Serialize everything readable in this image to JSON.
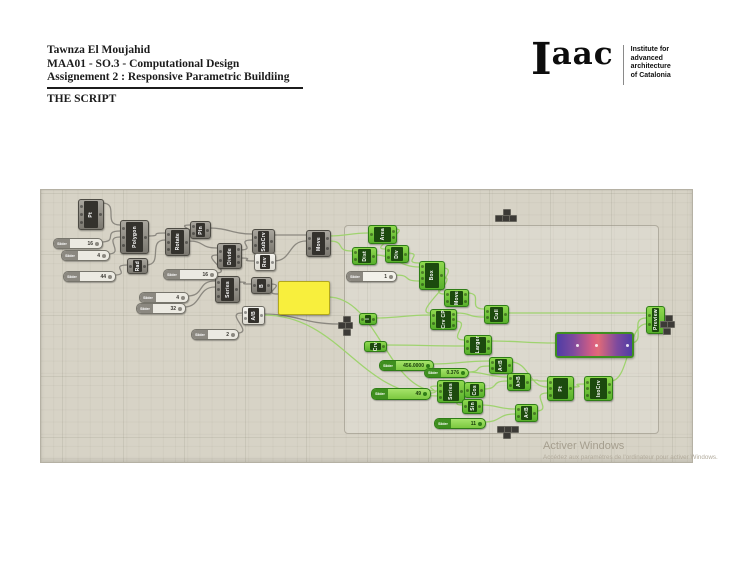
{
  "header": {
    "author": "Tawnza El Moujahid",
    "course": "MAA01 - SO.3 - Computational Design",
    "assignment": "Assignement 2 : Responsive Parametric Buildiing",
    "section_title": "THE SCRIPT"
  },
  "logo": {
    "wordmark_i": "I",
    "wordmark_rest": "aac",
    "tagline_lines": [
      "Institute for",
      "advanced",
      "architecture",
      "of Catalonia"
    ]
  },
  "watermark": {
    "line1": "Activer Windows",
    "line2": "Accédez aux paramètres de l'ordinateur pour activer Windows."
  },
  "colors": {
    "canvas_bg": "#d7d3c6",
    "node_dark": "#7b7870",
    "node_green": "#58b02b",
    "wire_gray": "#8b8880",
    "wire_green": "#9fd36f",
    "panel_yellow": "#f8ef3d",
    "gradient_purple": "#4f3da5",
    "gradient_red": "#e06a78"
  },
  "canvas": {
    "group": {
      "x": 344,
      "y": 225,
      "w": 313,
      "h": 207
    },
    "slider_label": "Slider",
    "nodes": [
      {
        "label": "Pt",
        "v": "dark",
        "x": 78,
        "y": 199,
        "w": 24,
        "h": 29,
        "ins": 3,
        "outs": 1
      },
      {
        "label": "Polygon",
        "v": "dark",
        "x": 120,
        "y": 220,
        "w": 27,
        "h": 32,
        "ins": 3,
        "outs": 1
      },
      {
        "label": "Rad",
        "v": "dark",
        "x": 127,
        "y": 258,
        "w": 19,
        "h": 14,
        "ins": 1,
        "outs": 1
      },
      {
        "label": "Rotate",
        "v": "dark",
        "x": 165,
        "y": 228,
        "w": 23,
        "h": 26,
        "ins": 3,
        "outs": 1
      },
      {
        "label": "Pln",
        "v": "dark",
        "x": 190,
        "y": 221,
        "w": 19,
        "h": 16,
        "ins": 2,
        "outs": 1
      },
      {
        "label": "Divide",
        "v": "dark",
        "x": 217,
        "y": 243,
        "w": 23,
        "h": 24,
        "ins": 2,
        "outs": 3
      },
      {
        "label": "SubCrv",
        "v": "dark",
        "x": 252,
        "y": 229,
        "w": 21,
        "h": 23,
        "ins": 2,
        "outs": 1
      },
      {
        "label": "Rev",
        "v": "white",
        "x": 254,
        "y": 253,
        "w": 20,
        "h": 16,
        "ins": 1,
        "outs": 1
      },
      {
        "label": "Move",
        "v": "dark",
        "x": 306,
        "y": 230,
        "w": 23,
        "h": 25,
        "ins": 2,
        "outs": 2
      },
      {
        "label": "Series",
        "v": "dark",
        "x": 215,
        "y": 276,
        "w": 23,
        "h": 25,
        "ins": 3,
        "outs": 1
      },
      {
        "label": "B",
        "v": "dark",
        "x": 251,
        "y": 277,
        "w": 19,
        "h": 15,
        "ins": 1,
        "outs": 1
      },
      {
        "label": "A/B",
        "v": "white",
        "x": 242,
        "y": 306,
        "w": 21,
        "h": 17,
        "ins": 2,
        "outs": 1
      },
      {
        "label": "Area",
        "v": "green",
        "x": 368,
        "y": 225,
        "w": 27,
        "h": 17,
        "ins": 1,
        "outs": 2
      },
      {
        "label": "Dist",
        "v": "green",
        "x": 352,
        "y": 247,
        "w": 23,
        "h": 16,
        "ins": 2,
        "outs": 1
      },
      {
        "label": "Div",
        "v": "green",
        "x": 385,
        "y": 245,
        "w": 22,
        "h": 16,
        "ins": 2,
        "outs": 1
      },
      {
        "label": "Box",
        "v": "green",
        "x": 419,
        "y": 261,
        "w": 24,
        "h": 27,
        "ins": 4,
        "outs": 1
      },
      {
        "label": "Move",
        "v": "green",
        "x": 444,
        "y": 289,
        "w": 23,
        "h": 16,
        "ins": 2,
        "outs": 2
      },
      {
        "label": "Crv CP",
        "v": "green",
        "x": 430,
        "y": 309,
        "w": 25,
        "h": 19,
        "ins": 2,
        "outs": 3
      },
      {
        "label": "Cull",
        "v": "green",
        "x": 484,
        "y": 305,
        "w": 23,
        "h": 17,
        "ins": 2,
        "outs": 1
      },
      {
        "label": "Larger",
        "v": "green",
        "x": 464,
        "y": 335,
        "w": 26,
        "h": 18,
        "ins": 2,
        "outs": 2
      },
      {
        "label": "Preview",
        "v": "green",
        "x": 646,
        "y": 306,
        "w": 17,
        "h": 26,
        "ins": 2,
        "outs": 0
      },
      {
        "label": "I",
        "v": "green",
        "x": 359,
        "y": 313,
        "w": 16,
        "h": 10,
        "ins": 1,
        "outs": 1
      },
      {
        "label": "Crv",
        "v": "green",
        "x": 364,
        "y": 341,
        "w": 21,
        "h": 9,
        "ins": 0,
        "outs": 1
      },
      {
        "label": "Series",
        "v": "green",
        "x": 437,
        "y": 380,
        "w": 26,
        "h": 21,
        "ins": 3,
        "outs": 1
      },
      {
        "label": "Cos",
        "v": "green",
        "x": 464,
        "y": 382,
        "w": 19,
        "h": 14,
        "ins": 1,
        "outs": 1
      },
      {
        "label": "Sin",
        "v": "green",
        "x": 462,
        "y": 399,
        "w": 19,
        "h": 13,
        "ins": 1,
        "outs": 1
      },
      {
        "label": "A<B",
        "v": "green",
        "x": 489,
        "y": 357,
        "w": 22,
        "h": 15,
        "ins": 2,
        "outs": 1
      },
      {
        "label": "A>B",
        "v": "green",
        "x": 507,
        "y": 373,
        "w": 22,
        "h": 16,
        "ins": 2,
        "outs": 1
      },
      {
        "label": "A<B",
        "v": "green",
        "x": 515,
        "y": 404,
        "w": 21,
        "h": 16,
        "ins": 2,
        "outs": 1
      },
      {
        "label": "Pt",
        "v": "green",
        "x": 547,
        "y": 376,
        "w": 25,
        "h": 23,
        "ins": 3,
        "outs": 1
      },
      {
        "label": "IsoCrv",
        "v": "green",
        "x": 584,
        "y": 376,
        "w": 27,
        "h": 23,
        "ins": 3,
        "outs": 2
      }
    ],
    "sliders": [
      {
        "v": "gray",
        "x": 53,
        "y": 238,
        "w": 48,
        "h": 9,
        "value": "16"
      },
      {
        "v": "gray",
        "x": 61,
        "y": 250,
        "w": 47,
        "h": 9,
        "value": "4"
      },
      {
        "v": "gray",
        "x": 63,
        "y": 271,
        "w": 51,
        "h": 9,
        "value": "44"
      },
      {
        "v": "gray",
        "x": 163,
        "y": 269,
        "w": 53,
        "h": 9,
        "value": "16"
      },
      {
        "v": "gray",
        "x": 139,
        "y": 292,
        "w": 48,
        "h": 9,
        "value": "4"
      },
      {
        "v": "gray",
        "x": 136,
        "y": 303,
        "w": 48,
        "h": 9,
        "value": "32"
      },
      {
        "v": "gray",
        "x": 191,
        "y": 329,
        "w": 46,
        "h": 9,
        "value": "2"
      },
      {
        "v": "white",
        "x": 346,
        "y": 271,
        "w": 49,
        "h": 9,
        "value": "1"
      },
      {
        "v": "green",
        "x": 379,
        "y": 360,
        "w": 53,
        "h": 9,
        "value": "456.0000"
      },
      {
        "v": "green",
        "x": 424,
        "y": 368,
        "w": 43,
        "h": 8,
        "value": "0.376"
      },
      {
        "v": "green",
        "x": 371,
        "y": 388,
        "w": 58,
        "h": 10,
        "value": "49"
      },
      {
        "v": "green",
        "x": 434,
        "y": 418,
        "w": 50,
        "h": 9,
        "value": "11"
      }
    ],
    "panel": {
      "x": 278,
      "y": 281,
      "w": 50,
      "h": 32
    },
    "gradient": {
      "x": 555,
      "y": 332,
      "w": 75,
      "h": 22,
      "dots": [
        0.25,
        0.5,
        0.92
      ]
    },
    "tiny_squares": [
      [
        503,
        209
      ],
      [
        495,
        215
      ],
      [
        502,
        215
      ],
      [
        509,
        215
      ],
      [
        343,
        316
      ],
      [
        338,
        322
      ],
      [
        345,
        322
      ],
      [
        343,
        329
      ],
      [
        665,
        315
      ],
      [
        660,
        321
      ],
      [
        667,
        321
      ],
      [
        663,
        328
      ],
      [
        497,
        426
      ],
      [
        504,
        426
      ],
      [
        511,
        426
      ],
      [
        503,
        432
      ]
    ],
    "wires": [
      {
        "c": "g",
        "p": [
          102,
          203,
          120,
          225
        ]
      },
      {
        "c": "g",
        "p": [
          101,
          242,
          120,
          231
        ]
      },
      {
        "c": "g",
        "p": [
          108,
          254,
          120,
          237
        ]
      },
      {
        "c": "g",
        "p": [
          114,
          275,
          127,
          265
        ]
      },
      {
        "c": "g",
        "p": [
          146,
          265,
          165,
          240
        ]
      },
      {
        "c": "g",
        "p": [
          147,
          236,
          165,
          233
        ]
      },
      {
        "c": "g",
        "p": [
          188,
          234,
          190,
          225
        ]
      },
      {
        "c": "g",
        "p": [
          209,
          228,
          252,
          234
        ]
      },
      {
        "c": "g",
        "p": [
          188,
          241,
          217,
          248
        ]
      },
      {
        "c": "g",
        "p": [
          216,
          273,
          217,
          255
        ]
      },
      {
        "c": "g",
        "p": [
          240,
          250,
          252,
          240
        ]
      },
      {
        "c": "g",
        "p": [
          240,
          258,
          254,
          261
        ]
      },
      {
        "c": "g",
        "p": [
          273,
          235,
          306,
          235
        ]
      },
      {
        "c": "g",
        "p": [
          274,
          261,
          306,
          241
        ]
      },
      {
        "c": "g",
        "p": [
          187,
          296,
          215,
          281
        ]
      },
      {
        "c": "g",
        "p": [
          184,
          307,
          215,
          287
        ]
      },
      {
        "c": "g",
        "p": [
          238,
          282,
          251,
          284
        ]
      },
      {
        "c": "g",
        "p": [
          270,
          284,
          278,
          294
        ]
      },
      {
        "c": "g",
        "p": [
          237,
          333,
          242,
          313
        ]
      },
      {
        "c": "g",
        "p": [
          263,
          314,
          338,
          324
        ]
      },
      {
        "c": "n",
        "p": [
          329,
          236,
          368,
          233
        ]
      },
      {
        "c": "n",
        "p": [
          329,
          241,
          352,
          251
        ]
      },
      {
        "c": "n",
        "p": [
          395,
          229,
          385,
          249
        ]
      },
      {
        "c": "n",
        "p": [
          375,
          255,
          419,
          267
        ]
      },
      {
        "c": "n",
        "p": [
          407,
          253,
          419,
          263
        ]
      },
      {
        "c": "n",
        "p": [
          395,
          275,
          419,
          281
        ]
      },
      {
        "c": "n",
        "p": [
          443,
          268,
          444,
          294
        ]
      },
      {
        "c": "n",
        "p": [
          443,
          277,
          430,
          313
        ]
      },
      {
        "c": "n",
        "p": [
          467,
          293,
          484,
          309
        ]
      },
      {
        "c": "n",
        "p": [
          455,
          313,
          484,
          317
        ]
      },
      {
        "c": "n",
        "p": [
          375,
          318,
          430,
          315
        ]
      },
      {
        "c": "n",
        "p": [
          507,
          313,
          646,
          313
        ]
      },
      {
        "c": "n",
        "p": [
          455,
          321,
          464,
          340
        ]
      },
      {
        "c": "n",
        "p": [
          385,
          345,
          464,
          346
        ]
      },
      {
        "c": "n",
        "p": [
          490,
          341,
          555,
          343
        ]
      },
      {
        "c": "n",
        "p": [
          630,
          343,
          646,
          318
        ]
      },
      {
        "c": "n",
        "p": [
          432,
          364,
          489,
          361
        ]
      },
      {
        "c": "n",
        "p": [
          467,
          372,
          489,
          366
        ]
      },
      {
        "c": "n",
        "p": [
          467,
          372,
          507,
          377
        ]
      },
      {
        "c": "n",
        "p": [
          429,
          393,
          437,
          386
        ]
      },
      {
        "c": "n",
        "p": [
          463,
          387,
          464,
          389
        ]
      },
      {
        "c": "n",
        "p": [
          463,
          391,
          462,
          405
        ]
      },
      {
        "c": "n",
        "p": [
          483,
          389,
          507,
          381
        ]
      },
      {
        "c": "n",
        "p": [
          481,
          405,
          515,
          409
        ]
      },
      {
        "c": "n",
        "p": [
          529,
          380,
          547,
          381
        ]
      },
      {
        "c": "n",
        "p": [
          511,
          362,
          547,
          387
        ]
      },
      {
        "c": "n",
        "p": [
          536,
          411,
          547,
          393
        ]
      },
      {
        "c": "n",
        "p": [
          572,
          387,
          584,
          384
        ]
      },
      {
        "c": "n",
        "p": [
          611,
          381,
          646,
          324
        ]
      },
      {
        "c": "n",
        "p": [
          484,
          422,
          515,
          414
        ]
      },
      {
        "c": "n",
        "p": [
          328,
          297,
          437,
          391
        ]
      },
      {
        "c": "n",
        "p": [
          263,
          315,
          437,
          396
        ]
      }
    ]
  }
}
